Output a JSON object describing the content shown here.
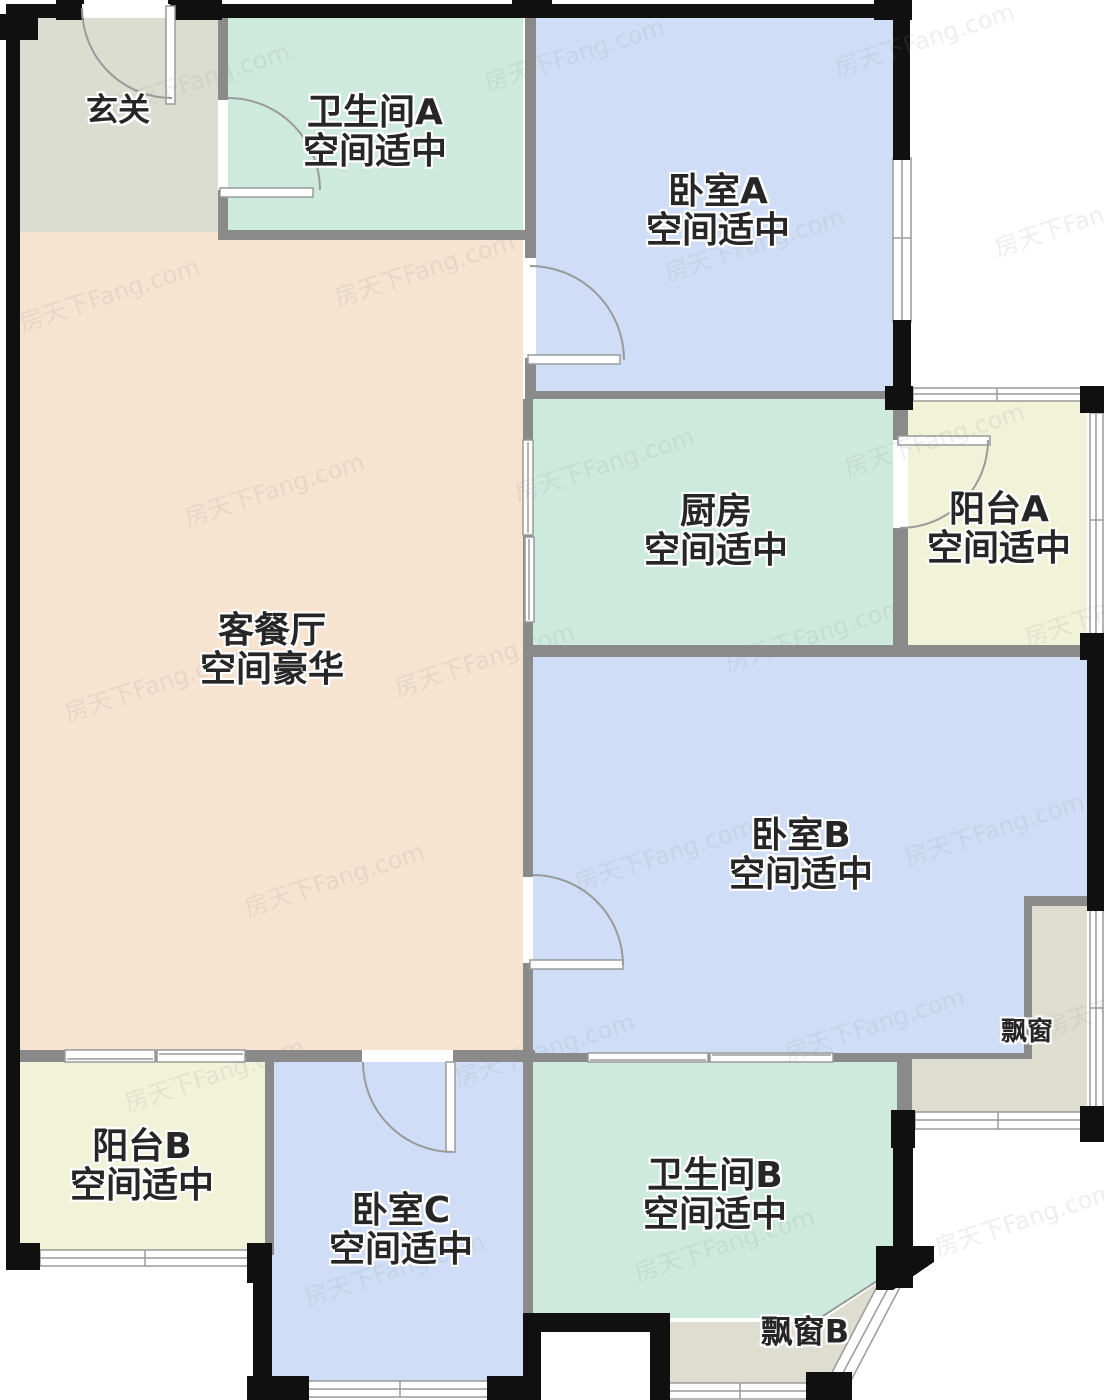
{
  "plan": {
    "title": "户型图",
    "rooms": {
      "foyer": {
        "name": "玄关",
        "size": ""
      },
      "bathroom_a": {
        "name": "卫生间A",
        "size": "空间适中"
      },
      "bedroom_a": {
        "name": "卧室A",
        "size": "空间适中"
      },
      "kitchen": {
        "name": "厨房",
        "size": "空间适中"
      },
      "balcony_a": {
        "name": "阳台A",
        "size": "空间适中"
      },
      "living_dining": {
        "name": "客餐厅",
        "size": "空间豪华"
      },
      "bedroom_b": {
        "name": "卧室B",
        "size": "空间适中"
      },
      "bay_window": {
        "name": "飘窗",
        "size": ""
      },
      "balcony_b": {
        "name": "阳台B",
        "size": "空间适中"
      },
      "bedroom_c": {
        "name": "卧室C",
        "size": "空间适中"
      },
      "bathroom_b": {
        "name": "卫生间B",
        "size": "空间适中"
      },
      "bay_window_b": {
        "name": "飘窗B",
        "size": ""
      }
    },
    "colors": {
      "c-foyer": "#dcddd1",
      "c-mint": "#cdeadd",
      "c-blue": "#cfdef6",
      "c-peach": "#f6e3d0",
      "c-yellow": "#f2f2d8",
      "c-beige": "#deddcf",
      "c-wallb": "#101010",
      "c-wallg": "#8a8a8a",
      "c-line": "#9a9a9a",
      "c-label": "#262626",
      "c-wm": "#8f8f8f"
    },
    "watermark": {
      "text": "房天下Fang.com",
      "positions": [
        [
          105,
          60
        ],
        [
          480,
          35
        ],
        [
          830,
          20
        ],
        [
          15,
          275
        ],
        [
          330,
          250
        ],
        [
          660,
          225
        ],
        [
          990,
          200
        ],
        [
          180,
          470
        ],
        [
          510,
          445
        ],
        [
          840,
          420
        ],
        [
          60,
          665
        ],
        [
          390,
          640
        ],
        [
          720,
          615
        ],
        [
          1020,
          590
        ],
        [
          240,
          860
        ],
        [
          570,
          835
        ],
        [
          900,
          810
        ],
        [
          120,
          1055
        ],
        [
          450,
          1030
        ],
        [
          780,
          1005
        ],
        [
          1040,
          980
        ],
        [
          300,
          1250
        ],
        [
          630,
          1225
        ],
        [
          930,
          1200
        ]
      ]
    }
  }
}
